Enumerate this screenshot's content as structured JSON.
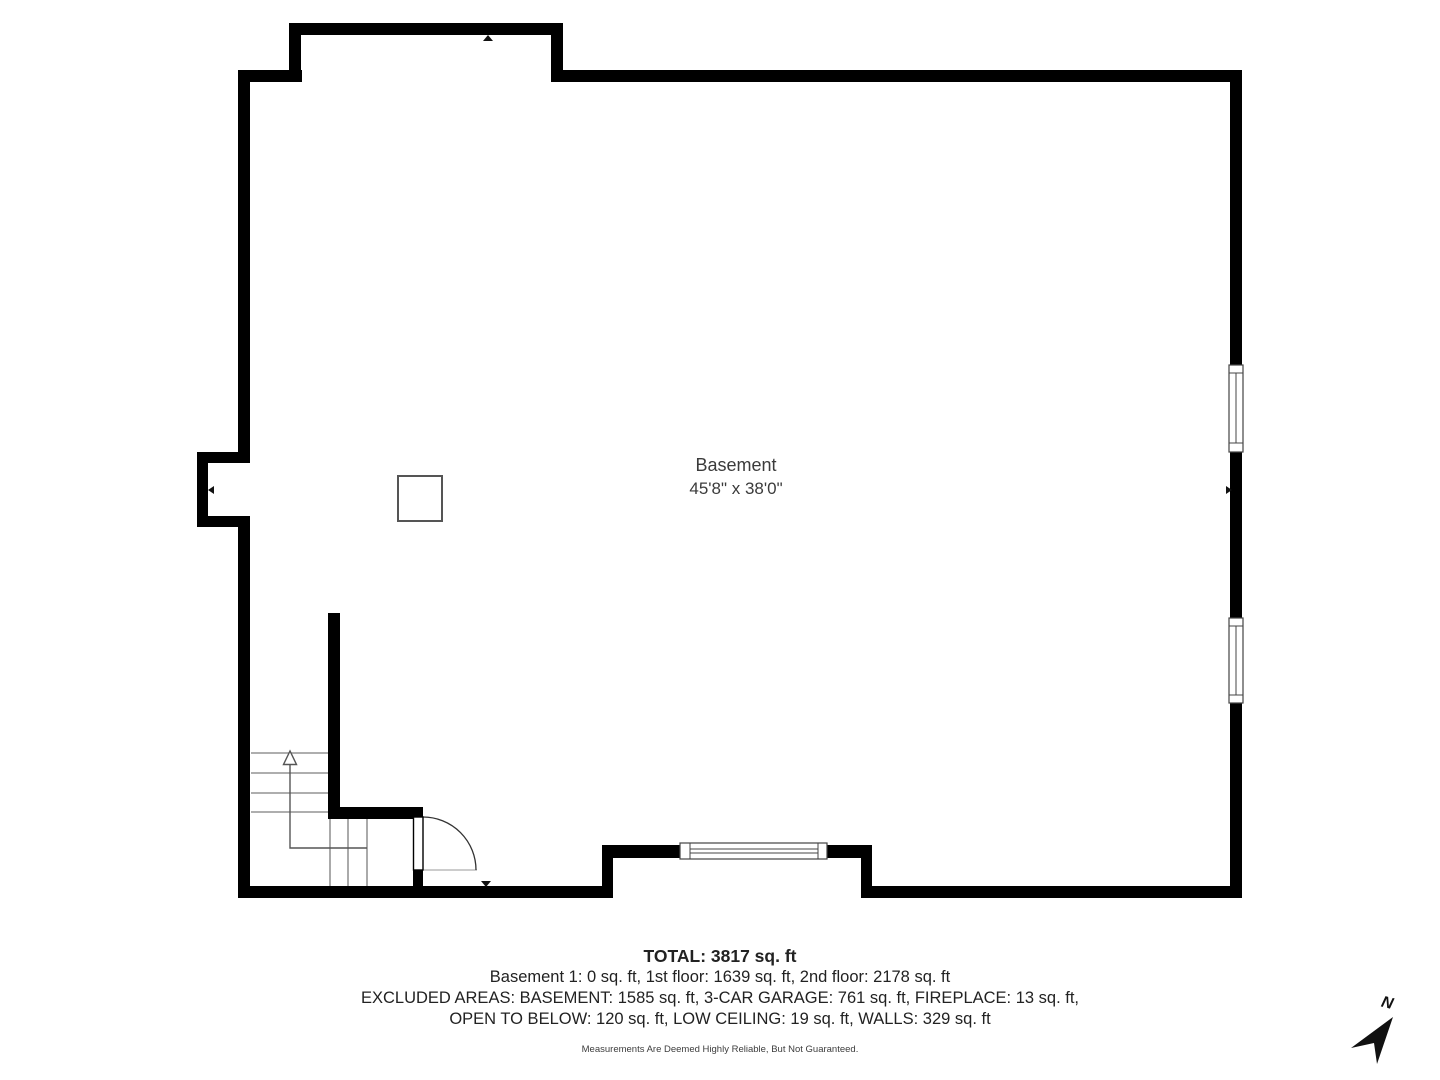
{
  "plan": {
    "room": {
      "name": "Basement",
      "dimensions": "45'8\" x 38'0\""
    }
  },
  "summary": {
    "total": "TOTAL: 3817 sq. ft",
    "floors": "Basement 1: 0 sq. ft, 1st floor: 1639 sq. ft, 2nd floor: 2178 sq. ft",
    "excluded_line1": "EXCLUDED AREAS: BASEMENT: 1585 sq. ft, 3-CAR GARAGE: 761 sq. ft, FIREPLACE: 13 sq. ft,",
    "excluded_line2": "OPEN TO BELOW: 120 sq. ft, LOW CEILING: 19 sq. ft, WALLS: 329 sq. ft",
    "disclaimer": "Measurements Are Deemed Highly Reliable, But Not Guaranteed."
  },
  "compass": {
    "north_label": "N"
  },
  "colors": {
    "wall": "#000000",
    "stair_line": "#7d7d7d",
    "text": "#222222"
  }
}
